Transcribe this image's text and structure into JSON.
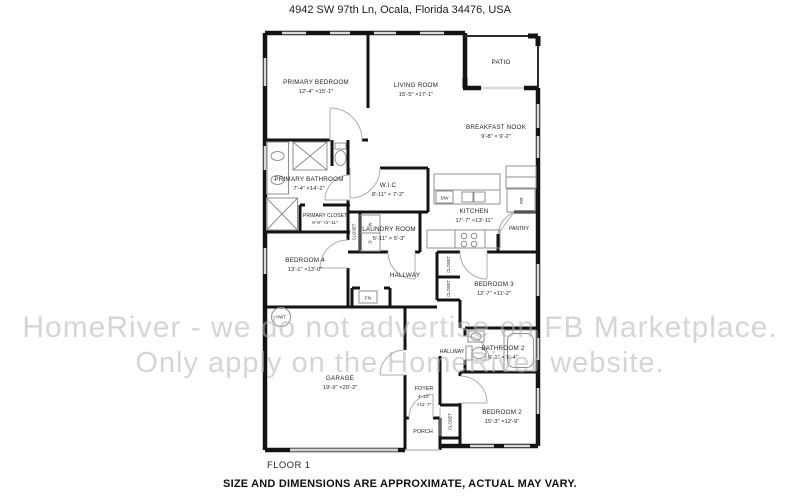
{
  "header": {
    "address": "4942 SW 97th Ln, Ocala, Florida 34476, USA"
  },
  "footer": {
    "floor_label": "FLOOR 1",
    "disclaimer": "SIZE AND DIMENSIONS ARE APPROXIMATE, ACTUAL MAY VARY."
  },
  "watermark": {
    "line1": "HomeRiver - we do not advertise on FB Marketplace.",
    "line2": "Only apply on the HomeRiver website."
  },
  "colors": {
    "wall": "#141414",
    "window": "#d9d9d9",
    "door_arc": "#adadad",
    "fixture": "#8f8f8f",
    "watermark": "#b2b2b2"
  },
  "rooms": {
    "primary_bedroom": {
      "name": "PRIMARY BEDROOM",
      "dims": "12'-4\" ×15'-1\""
    },
    "living_room": {
      "name": "LIVING ROOM",
      "dims": "15'-5\" ×17'-1\""
    },
    "patio": {
      "name": "PATIO"
    },
    "breakfast_nook": {
      "name": "BREAKFAST NOOK",
      "dims": "9'-8\" × 9'-2\""
    },
    "primary_bathroom": {
      "name": "PRIMARY BATHROOM",
      "dims": "7'-4\" ×14'-2\""
    },
    "wic": {
      "name": "W.I.C",
      "dims": "8'-11\" × 7'-2\""
    },
    "primary_closet": {
      "name": "PRIMARY CLOSET",
      "dims": "6'-0\" ×2'-11\""
    },
    "kitchen": {
      "name": "KITCHEN",
      "dims": "17'-7\" ×13'-11\""
    },
    "laundry": {
      "name": "LAUNDRY ROOM",
      "dims": "5'-11\" × 5'-3\""
    },
    "pantry": {
      "name": "PANTRY"
    },
    "bedroom4": {
      "name": "BEDROOM 4",
      "dims": "13'-1\" ×13'-0\""
    },
    "hallway_upper": {
      "name": "HALLWAY"
    },
    "bedroom3": {
      "name": "BEDROOM 3",
      "dims": "12'-7\" ×11'-2\""
    },
    "hallway_lower": {
      "name": "HALLWAY"
    },
    "bathroom2": {
      "name": "BATHROOM 2",
      "dims": "9'-1\" × 5'-4\""
    },
    "garage": {
      "name": "GARAGE",
      "dims": "19'-9\" ×20'-2\""
    },
    "foyer": {
      "name": "FOYER",
      "dims_line1": "4'-10\"",
      "dims_line2": "×11'-7\""
    },
    "porch": {
      "name": "PORCH"
    },
    "bedroom2": {
      "name": "BEDROOM 2",
      "dims": "15'-3\" ×12'-9\""
    }
  },
  "labels": {
    "closet": "CLOSET",
    "hwt": "HWT",
    "fn": "FN",
    "dw": "DW",
    "fr": "FR",
    "washer": "W",
    "dryer": "D"
  }
}
